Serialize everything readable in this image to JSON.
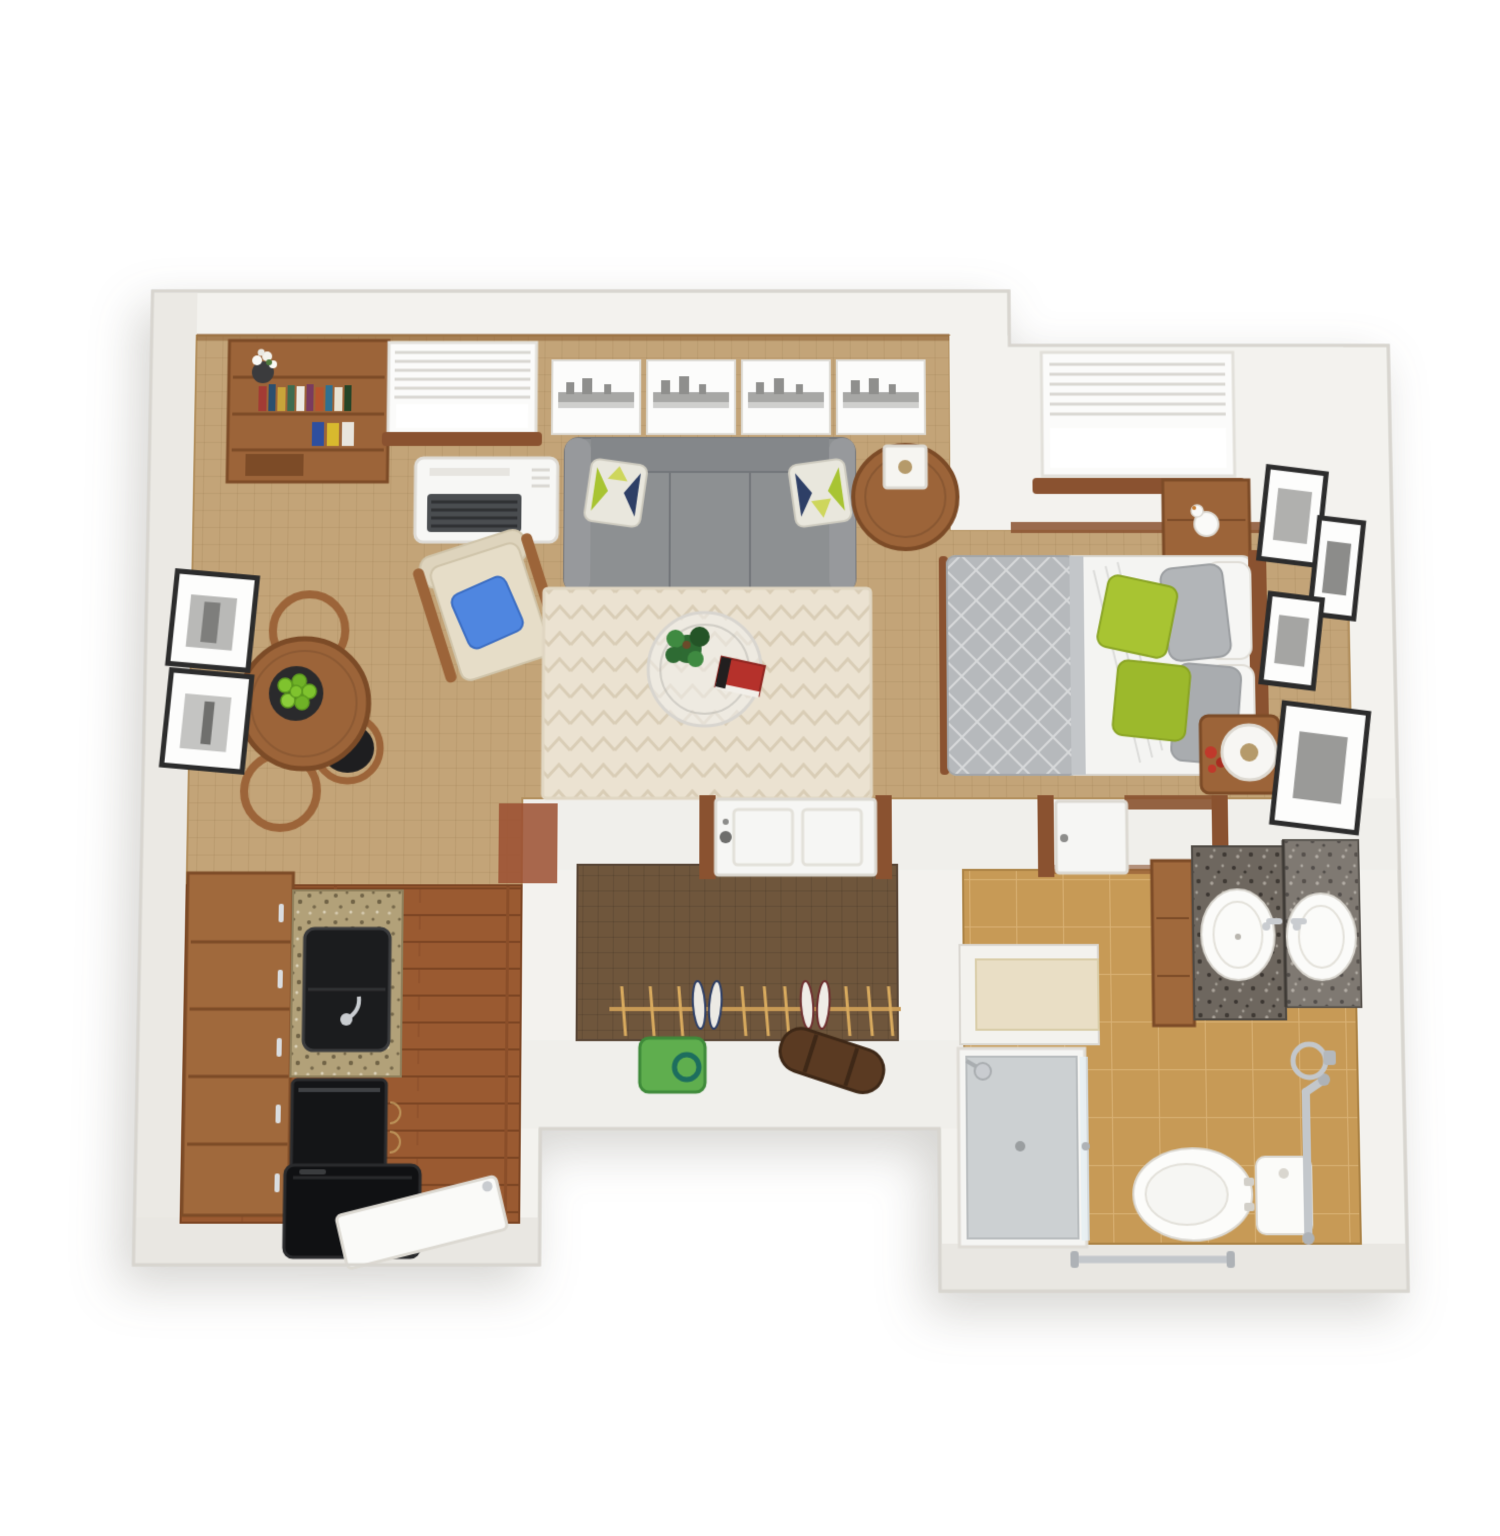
{
  "scene": {
    "kind": "3d-floor-plan-render",
    "description": "Top-down 3D rendering of a studio apartment: open living/sleeping area, galley kitchen, entry closet and accessible bathroom",
    "background": "#ffffff"
  },
  "palette": {
    "wall": "#f3f2ee",
    "wall_band_light": "#f0efeb",
    "wall_band_dark": "#e9e7e2",
    "wall_west": "#ebe9e4",
    "wall_edge": "#d8d5cf",
    "carpet": "#c3a478",
    "wood_floor_base": "#9a5a31",
    "closet_floor_base": "#6f563c",
    "bath_tile_base": "#c79a56",
    "rug_base": "#ebe2d1",
    "rug_stripe": "#d9cdb6",
    "trim_wood": "#8a5230",
    "furniture_wood": "#9c6439",
    "furniture_wood_dark": "#7c4b27",
    "sofa_gray": "#8d9092",
    "sofa_arm": "#97999c",
    "sofa_back": "#84878a",
    "sofa_seam": "#74767a",
    "cushion_cream": "#e6ddc8",
    "pillow_blue": "#4f86e0",
    "pillow_green": "#a8c432",
    "pillow_green_dark": "#9cb92c",
    "pillow_gray": "#b2b5b8",
    "pillow_white": "#f6f6f4",
    "mattress_white": "#f4f4f2",
    "quilt_gray": "#b6b9bc",
    "appliance_black": "#141517",
    "sink_black": "#1b1c1e",
    "chrome": "#c3c7cb",
    "white_fixture": "#fbfbf9",
    "shower_floor": "#ccd0d2",
    "glass": "#e8f0f3",
    "door_white": "#f6f6f4",
    "apple_green": "#7fc32e",
    "plant_green": "#2e6b33",
    "plant_green_light": "#3f8a41",
    "book_red": "#b5312b",
    "art_panel": "#fcfcfb",
    "art_gray": "#a7a7a5",
    "frame_black": "#2c2c2c",
    "bag_green": "#5fae4e",
    "duffel_brown": "#5a3a22",
    "hanger_tan": "#d8aa5e",
    "niche_cream": "#e9dec5"
  },
  "rooms": {
    "living": {
      "name": "living-area",
      "items_summary": "bookshelf with books and flowers, window with blinds, wall air-conditioner, 4-panel city skyline wall art, gray sofa with two patterned pillows, round wood side table with cube lamp, beige armchair with blue pillow, chevron area rug, glass coffee table with plant and red book, round dining table with bowl of green apples and three chairs, two framed prints on west wall"
    },
    "bedroom": {
      "name": "sleeping-area",
      "items_summary": "window with blinds, wooden nightstand with swan decor, bed with gray quilt, white sheets, green gray and white pillows, wooden headboard, corner table with drum lamp and red flowers, four framed prints on east wall"
    },
    "kitchen": {
      "name": "kitchen",
      "items_summary": "wood plank floor, wooden cabinet run with chrome pulls, speckled granite counter, black sink with faucet, black under-counter appliance, black refrigerator, leaning white board"
    },
    "closet": {
      "name": "entry-closet",
      "items_summary": "white entry door with wood jambs, dark carpet, clothes rod with hangers, two pairs of shoes, green tote bag, brown duffel bag"
    },
    "bathroom": {
      "name": "bathroom",
      "items_summary": "door to sleeping area, corner granite vanity with mirror and two round basins, wooden vanity cabinet, cream-topped half wall niche, glass shower with shower head, toilet, vertical grab bar, towel ring, horizontal towel bar, tan tile floor"
    }
  }
}
